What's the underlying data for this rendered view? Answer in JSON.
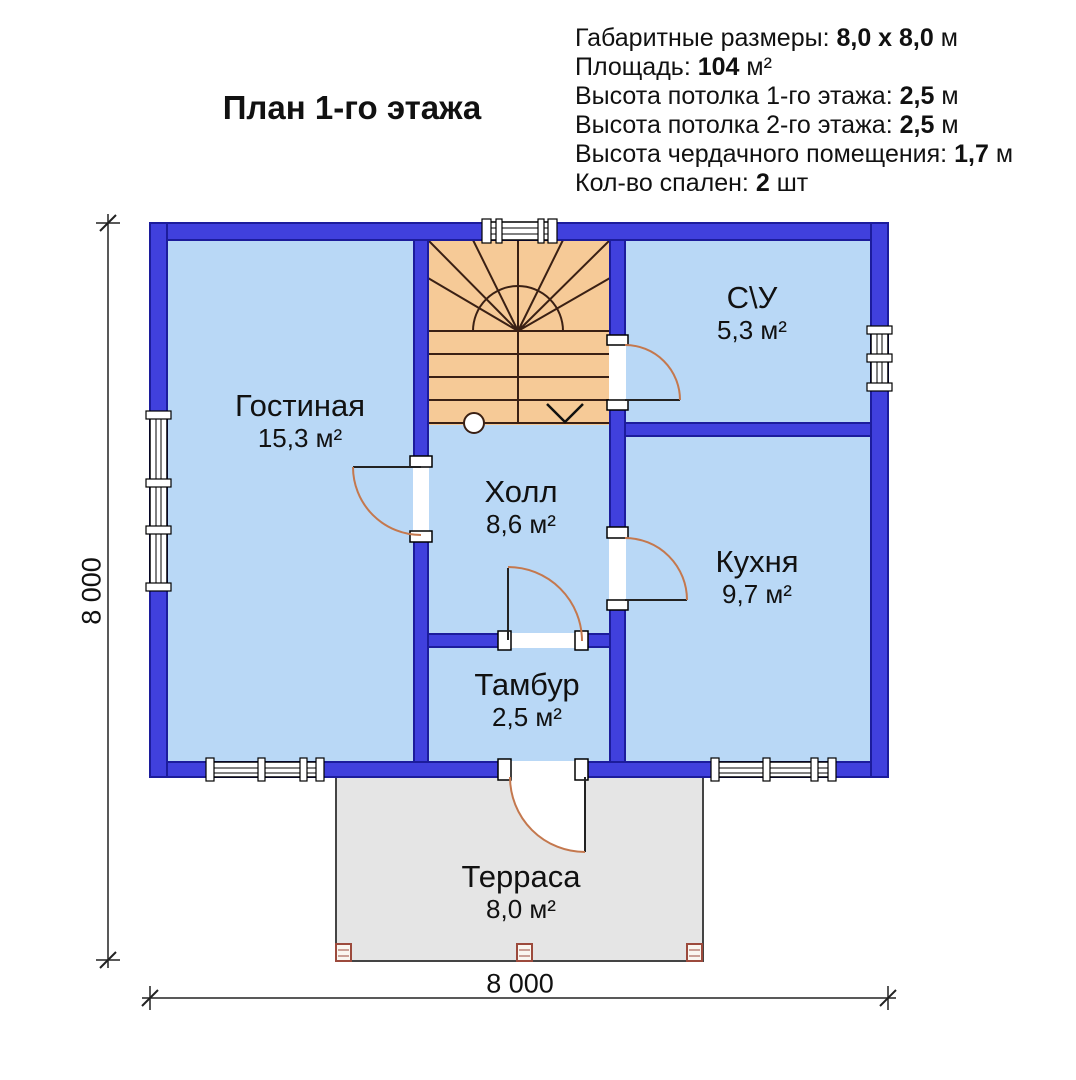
{
  "title": "План 1-го этажа",
  "specs": {
    "lines": [
      {
        "label": "Габаритные размеры:",
        "value": "8,0 x 8,0",
        "unit": "м"
      },
      {
        "label": "Площадь:",
        "value": "104",
        "unit": "м²"
      },
      {
        "label": "Высота потолка 1-го этажа:",
        "value": "2,5",
        "unit": "м"
      },
      {
        "label": "Высота потолка 2-го этажа:",
        "value": "2,5",
        "unit": "м"
      },
      {
        "label": "Высота чердачного помещения:",
        "value": "1,7",
        "unit": "м"
      },
      {
        "label": "Кол-во спален:",
        "value": "2",
        "unit": "шт"
      }
    ]
  },
  "rooms": [
    {
      "name": "Гостиная",
      "area": "15,3 м²"
    },
    {
      "name": "С\\У",
      "area": "5,3 м²"
    },
    {
      "name": "Холл",
      "area": "8,6 м²"
    },
    {
      "name": "Кухня",
      "area": "9,7 м²"
    },
    {
      "name": "Тамбур",
      "area": "2,5 м²"
    },
    {
      "name": "Терраса",
      "area": "8,0 м²"
    }
  ],
  "dimensions": {
    "width_label": "8 000",
    "height_label": "8 000"
  },
  "colors": {
    "wall": "#4040dd",
    "wall-border": "#1c1c9c",
    "room": "#b9d8f6",
    "stairs": "#f6ca97",
    "stairs-line": "#3a2014",
    "terrace": "#e5e5e5",
    "terrace-border": "#444444",
    "door-arc": "#c4784e",
    "post": "#9c4a3c",
    "dim": "#222222",
    "ink": "#111111"
  }
}
